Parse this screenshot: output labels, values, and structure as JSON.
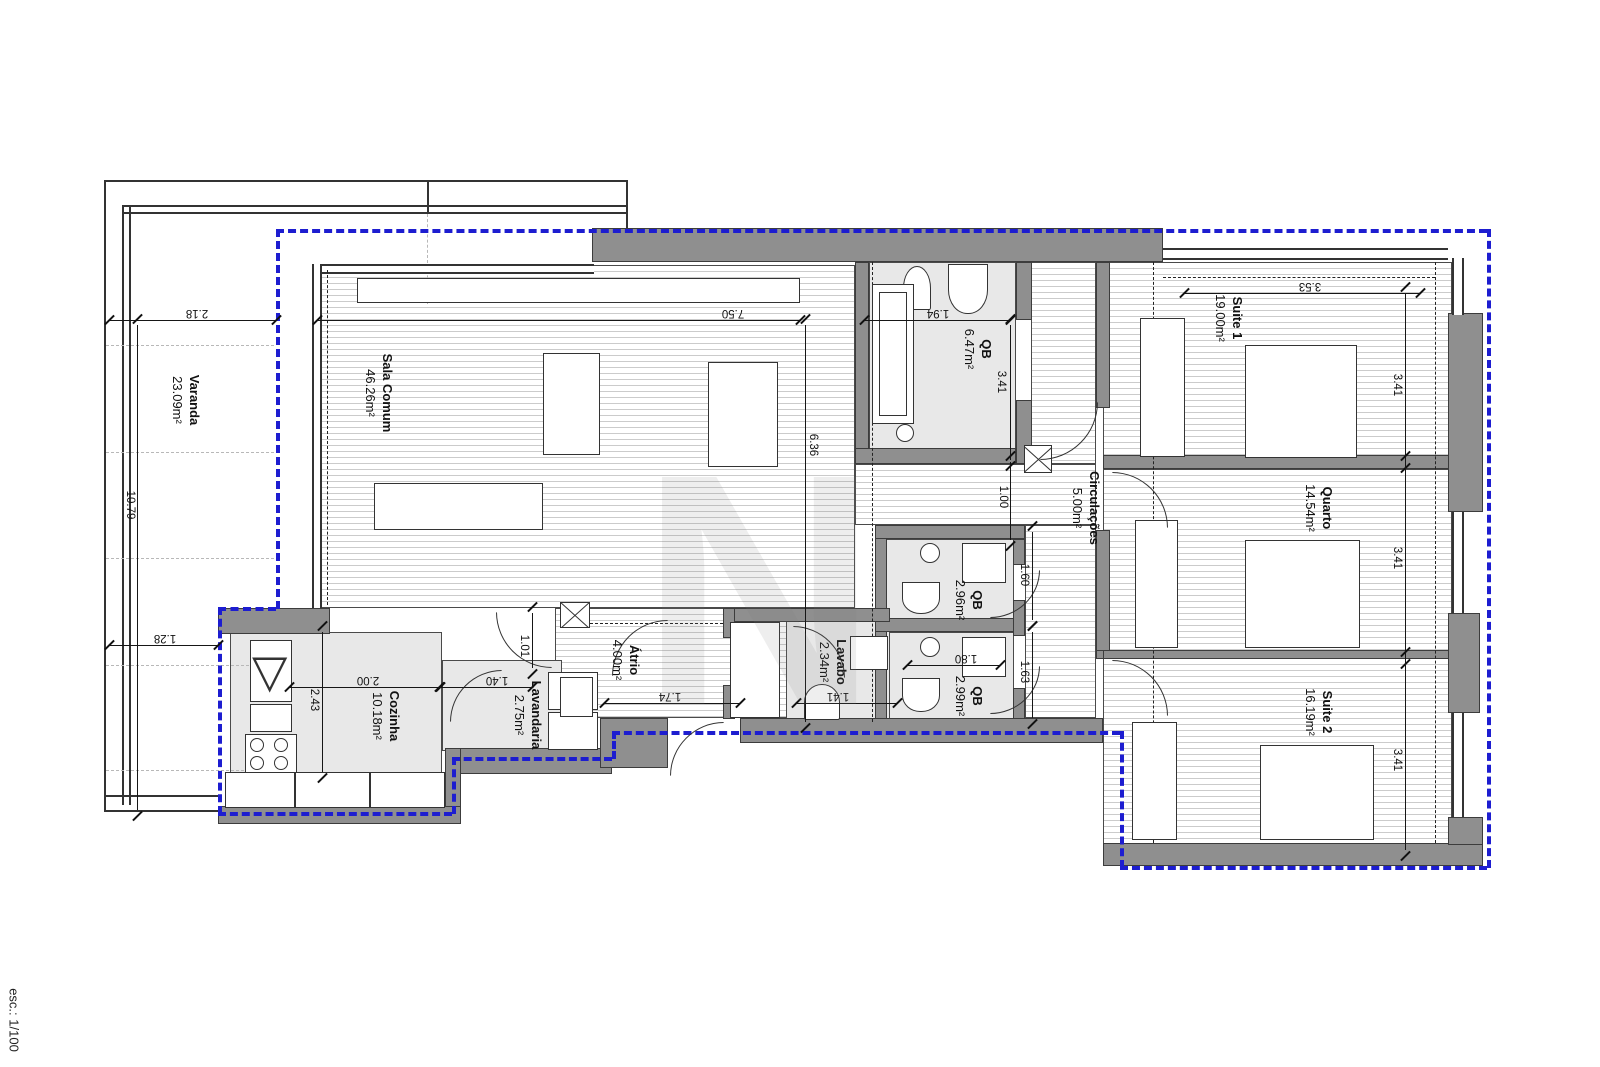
{
  "meta": {
    "scale_label": "esc.: 1/100"
  },
  "watermark": {
    "letter": "N"
  },
  "rooms": [
    {
      "name": "Varanda",
      "area": "23.09m²"
    },
    {
      "name": "Sala Comum",
      "area": "46.26m²"
    },
    {
      "name": "Cozinha",
      "area": "10.18m²"
    },
    {
      "name": "Lavandaria",
      "area": "2.75m²"
    },
    {
      "name": "Átrio",
      "area": "4.00m²"
    },
    {
      "name": "Lavabo",
      "area": "2.34m²"
    },
    {
      "name": "QB",
      "area": "6.47m²"
    },
    {
      "name": "QB",
      "area": "2.96m²"
    },
    {
      "name": "QB",
      "area": "2.99m²"
    },
    {
      "name": "Circulações",
      "area": "5.00m²"
    },
    {
      "name": "Suite 1",
      "area": "19.00m²"
    },
    {
      "name": "Quarto",
      "area": "14.54m²"
    },
    {
      "name": "Suite 2",
      "area": "16.19m²"
    }
  ],
  "dims": [
    "2.18",
    "7.50",
    "1.94",
    "3.53",
    "10.79",
    "1.28",
    "2.43",
    "2.00",
    "1.01",
    "1.40",
    "1.74",
    "1.41",
    "1.80",
    "6.36",
    "3.41",
    "1.00",
    "1.60",
    "1.63",
    "3.41",
    "3.41",
    "3.41"
  ]
}
